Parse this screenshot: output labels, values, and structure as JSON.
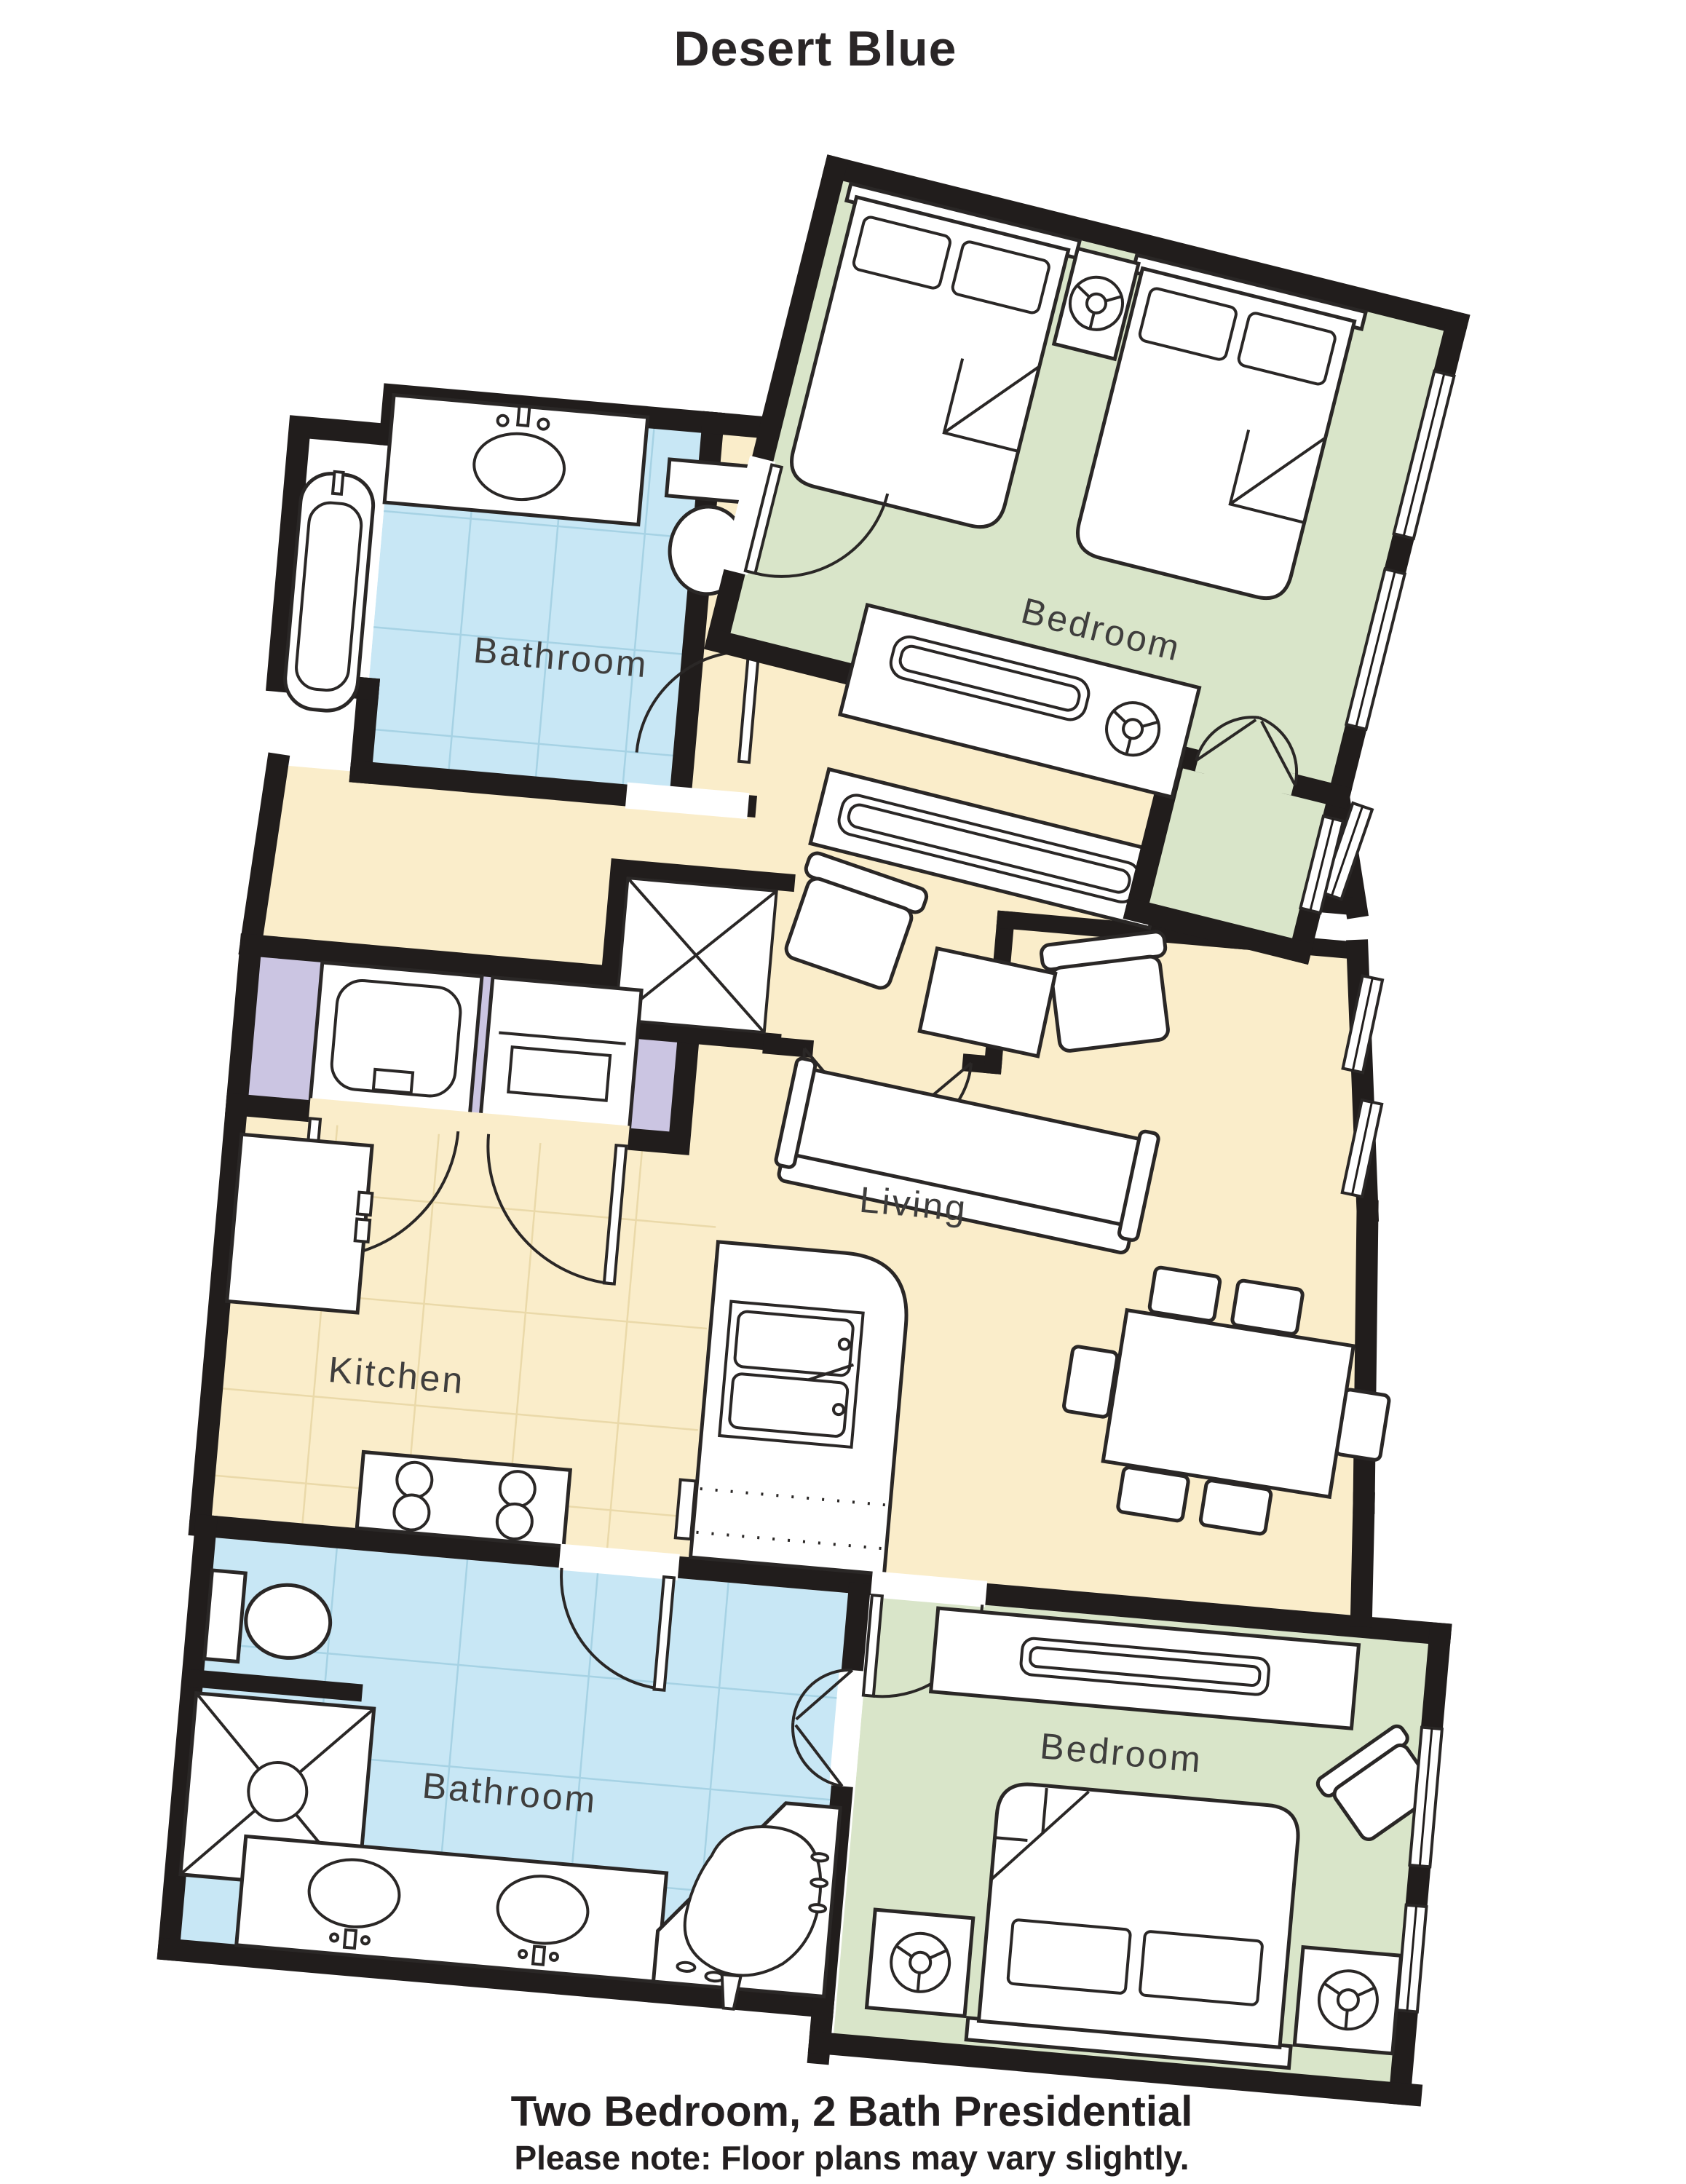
{
  "title": "Desert Blue",
  "footer": {
    "line1": "Two Bedroom, 2 Bath Presidential",
    "line2": "Please note: Floor plans may vary slightly."
  },
  "rooms": {
    "bedroom_top": "Bedroom",
    "bathroom_top": "Bathroom",
    "living": "Living",
    "kitchen": "Kitchen",
    "bathroom_bottom": "Bathroom",
    "bedroom_bottom": "Bedroom"
  },
  "legend": {
    "bedroom_color": "#d9e5c9",
    "living_kitchen_color": "#faedca",
    "bathroom_color": "#c8e7f5",
    "laundry_color": "#cbc5e2",
    "wall_color": "#211d1c"
  }
}
